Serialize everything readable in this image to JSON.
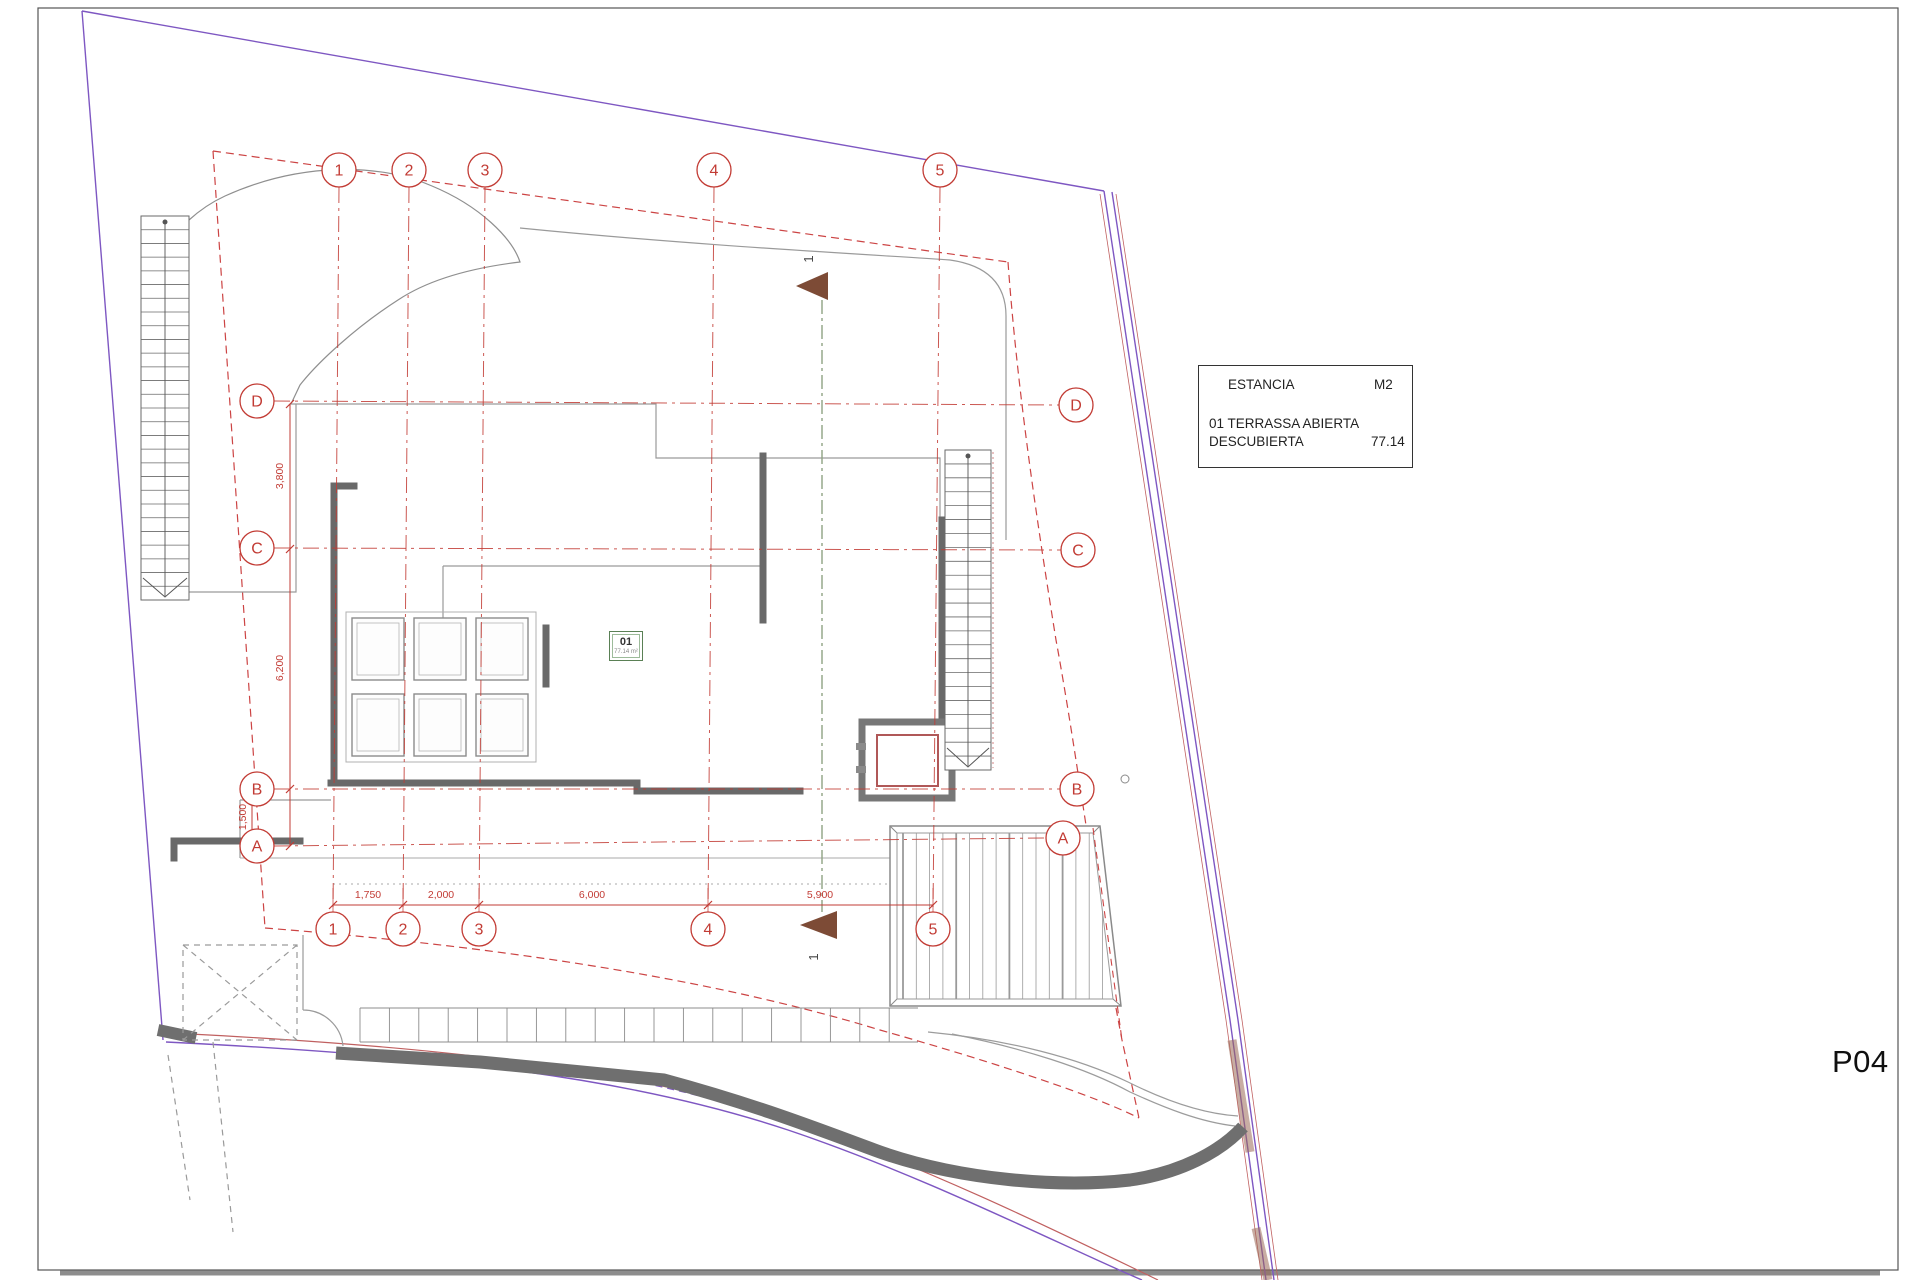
{
  "page": {
    "sheet_code": "P04"
  },
  "legend": {
    "header_estancia": "ESTANCIA",
    "header_m2": "M2",
    "row_name_line1": "01 TERRASSA ABIERTA",
    "row_name_line2": "DESCUBIERTA",
    "row_value": "77.14"
  },
  "room_label": {
    "number": "01",
    "area": "77.14 m²"
  },
  "grid": {
    "columns": [
      "1",
      "2",
      "3",
      "4",
      "5"
    ],
    "rows": [
      "D",
      "C",
      "B",
      "A"
    ]
  },
  "dimensions": {
    "bottom": [
      "1,750",
      "2,000",
      "6,000",
      "5,900"
    ],
    "left": [
      "3,800",
      "6,200",
      "1,500"
    ]
  },
  "section": {
    "label": "1"
  },
  "colors": {
    "axis_red": "#c23b34",
    "setback_red": "#cc4444",
    "boundary_purple": "#7e57c2",
    "road_red": "#c06060",
    "wall_gray": "#696969",
    "outline_gray": "#9a9a9a",
    "section_green": "#8fa383",
    "marker_brown": "#7d4b36"
  }
}
